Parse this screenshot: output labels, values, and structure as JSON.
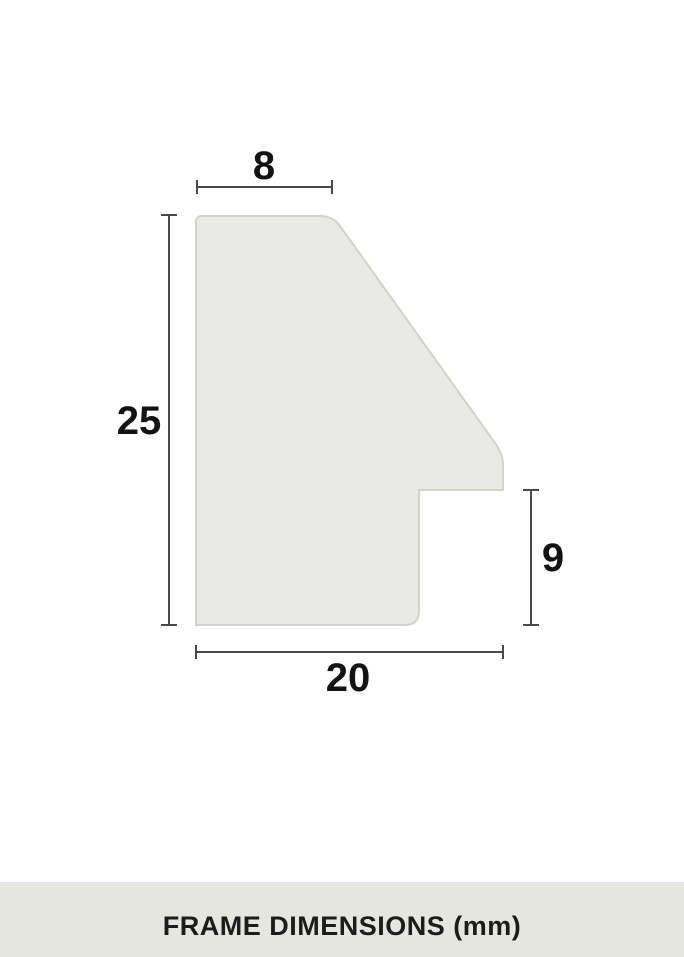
{
  "colors": {
    "page_bg": "#ffffff",
    "profile_fill": "#e9e9e5",
    "profile_stroke": "#d3d3cd",
    "dimension_line": "#4a4a4a",
    "label_text": "#121212",
    "footer_bg": "#e6e6e1",
    "footer_text": "#1c1c1c"
  },
  "diagram": {
    "type": "frame-moulding-cross-section",
    "dimensions": {
      "top_width": "8",
      "left_height": "25",
      "bottom_depth": "20",
      "right_rabbet": "9"
    }
  },
  "footer": {
    "caption": "FRAME DIMENSIONS (mm)"
  }
}
